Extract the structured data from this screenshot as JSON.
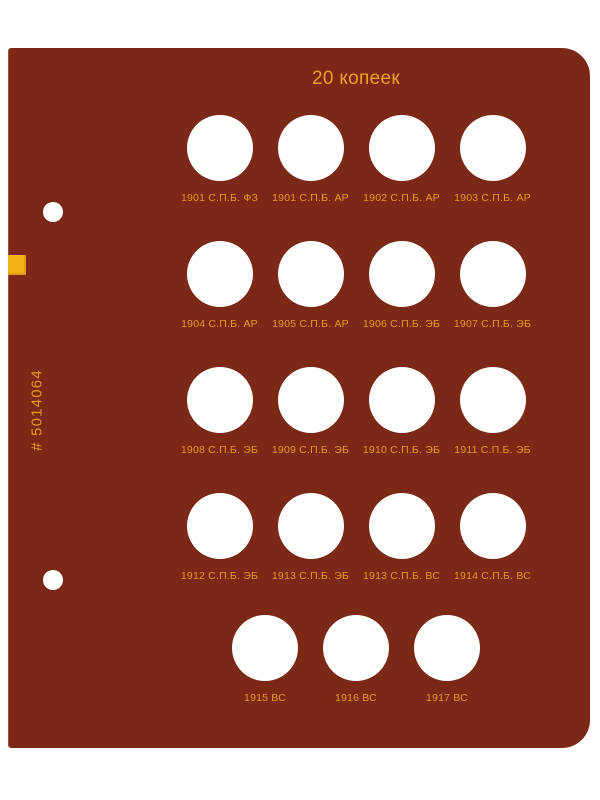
{
  "title": "20 копеек",
  "serial": "# 5014064",
  "colors": {
    "page_background": "#7B2817",
    "gold_text": "#EAA12B",
    "label_text": "#E8981F",
    "spine_tab": "#F3B315",
    "slot_fill": "#FEFEFE",
    "canvas_background": "#FFFFFF"
  },
  "rows": [
    {
      "labels": [
        "1901 С.П.Б. ФЗ",
        "1901 С.П.Б. АР",
        "1902 С.П.Б. АР",
        "1903 С.П.Б. АР"
      ]
    },
    {
      "labels": [
        "1904 С.П.Б. АР",
        "1905 С.П.Б. АР",
        "1906 С.П.Б. ЭБ",
        "1907 С.П.Б. ЭБ"
      ]
    },
    {
      "labels": [
        "1908 С.П.Б. ЭБ",
        "1909 С.П.Б. ЭБ",
        "1910 С.П.Б. ЭБ",
        "1911 С.П.Б. ЭБ"
      ]
    },
    {
      "labels": [
        "1912 С.П.Б. ЭБ",
        "1913 С.П.Б. ЭБ",
        "1913 С.П.Б. ВС",
        "1914 С.П.Б. ВС"
      ]
    },
    {
      "labels": [
        "1915 ВС",
        "1916 ВС",
        "1917 ВС"
      ]
    }
  ]
}
